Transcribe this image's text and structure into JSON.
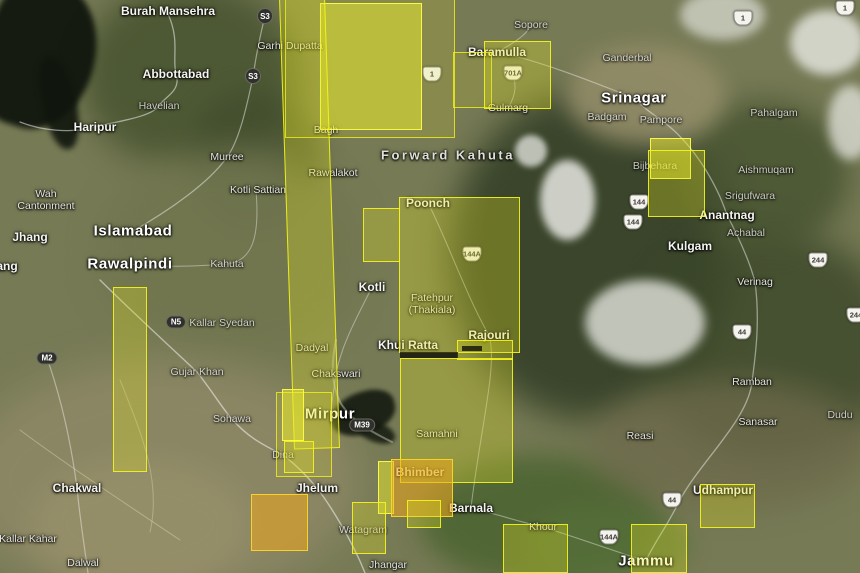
{
  "app": {
    "name": "satellite-map-viewer",
    "region": "Kashmir / Northern Pakistan"
  },
  "colors": {
    "footprint_yellow": "#e2e222",
    "footprint_bright": "#ededd2d",
    "footprint_orange": "#eea81c",
    "footprint_border": "#f5f519",
    "shield_dark": "#30312c",
    "shield_light": "#f5f3ee",
    "terrain_base": "#767a55"
  },
  "map": {
    "labels": [
      {
        "text": "Burah Mansehra",
        "x": 168,
        "y": 11,
        "s": "md"
      },
      {
        "text": "Abbottabad",
        "x": 176,
        "y": 74,
        "s": "md"
      },
      {
        "text": "Havelian",
        "x": 159,
        "y": 106,
        "s": "sm",
        "dim": true
      },
      {
        "text": "Haripur",
        "x": 95,
        "y": 127,
        "s": "md"
      },
      {
        "text": "Murree",
        "x": 227,
        "y": 157,
        "s": "sm"
      },
      {
        "text": "Kotli Sattian",
        "x": 258,
        "y": 190,
        "s": "sm"
      },
      {
        "text": "Wah Cantonment",
        "x": 46,
        "y": 200,
        "s": "sm",
        "w": 64
      },
      {
        "text": "Jhang",
        "x": 30,
        "y": 237,
        "s": "md"
      },
      {
        "text": "Islamabad",
        "x": 133,
        "y": 231,
        "s": "lg"
      },
      {
        "text": "Rawalpindi",
        "x": 130,
        "y": 264,
        "s": "lg"
      },
      {
        "text": "Kahuta",
        "x": 227,
        "y": 264,
        "s": "sm",
        "dim": true
      },
      {
        "text": "Fateh Jang",
        "x": -14,
        "y": 266,
        "s": "md"
      },
      {
        "text": "Kallar Syedan",
        "x": 222,
        "y": 323,
        "s": "sm",
        "dim": true
      },
      {
        "text": "Gujar Khan",
        "x": 197,
        "y": 372,
        "s": "sm",
        "dim": true
      },
      {
        "text": "Sohawa",
        "x": 232,
        "y": 419,
        "s": "sm",
        "dim": true
      },
      {
        "text": "Chakwal",
        "x": 77,
        "y": 488,
        "s": "md"
      },
      {
        "text": "Kallar Kahar",
        "x": 28,
        "y": 539,
        "s": "sm"
      },
      {
        "text": "Dalwal",
        "x": 83,
        "y": 563,
        "s": "sm"
      },
      {
        "text": "Dina",
        "x": 283,
        "y": 455,
        "s": "sm",
        "dim": true
      },
      {
        "text": "Jhelum",
        "x": 317,
        "y": 488,
        "s": "md"
      },
      {
        "text": "Mirpur",
        "x": 330,
        "y": 414,
        "s": "lg"
      },
      {
        "text": "Chakswari",
        "x": 336,
        "y": 374,
        "s": "sm"
      },
      {
        "text": "Dadyal",
        "x": 312,
        "y": 348,
        "s": "sm"
      },
      {
        "text": "Jhangar",
        "x": 388,
        "y": 565,
        "s": "sm"
      },
      {
        "text": "Watagram",
        "x": 363,
        "y": 530,
        "s": "sm",
        "dim": true
      },
      {
        "text": "Bhimber",
        "x": 420,
        "y": 472,
        "s": "md"
      },
      {
        "text": "Barnala",
        "x": 471,
        "y": 508,
        "s": "md"
      },
      {
        "text": "Samahni",
        "x": 437,
        "y": 434,
        "s": "sm"
      },
      {
        "text": "Khui Ratta",
        "x": 408,
        "y": 345,
        "s": "md"
      },
      {
        "text": "Kotli",
        "x": 372,
        "y": 287,
        "s": "md"
      },
      {
        "text": "Fatehpur (Thakiala)",
        "x": 432,
        "y": 304,
        "s": "sm",
        "w": 62
      },
      {
        "text": "Rajouri",
        "x": 489,
        "y": 335,
        "s": "md"
      },
      {
        "text": "Poonch",
        "x": 428,
        "y": 203,
        "s": "md"
      },
      {
        "text": "Forward Kahuta",
        "x": 448,
        "y": 155,
        "s": "area"
      },
      {
        "text": "Bagh",
        "x": 326,
        "y": 130,
        "s": "sm"
      },
      {
        "text": "Rawalakot",
        "x": 333,
        "y": 173,
        "s": "sm"
      },
      {
        "text": "Garhi Dupatta",
        "x": 290,
        "y": 46,
        "s": "sm"
      },
      {
        "text": "Sopore",
        "x": 531,
        "y": 25,
        "s": "sm",
        "dim": true
      },
      {
        "text": "Baramulla",
        "x": 497,
        "y": 52,
        "s": "md"
      },
      {
        "text": "Gulmarg",
        "x": 508,
        "y": 108,
        "s": "sm"
      },
      {
        "text": "Srinagar",
        "x": 634,
        "y": 98,
        "s": "lg"
      },
      {
        "text": "Ganderbal",
        "x": 627,
        "y": 58,
        "s": "sm",
        "dim": true
      },
      {
        "text": "Badgam",
        "x": 607,
        "y": 117,
        "s": "sm",
        "dim": true
      },
      {
        "text": "Pampore",
        "x": 661,
        "y": 120,
        "s": "sm",
        "dim": true
      },
      {
        "text": "Pahalgam",
        "x": 774,
        "y": 113,
        "s": "sm",
        "dim": true
      },
      {
        "text": "Aishmuqam",
        "x": 766,
        "y": 170,
        "s": "sm",
        "dim": true
      },
      {
        "text": "Srigufwara",
        "x": 750,
        "y": 196,
        "s": "sm",
        "dim": true
      },
      {
        "text": "Bijbehara",
        "x": 655,
        "y": 166,
        "s": "sm",
        "dim": true
      },
      {
        "text": "Anantnag",
        "x": 727,
        "y": 215,
        "s": "md"
      },
      {
        "text": "Achabal",
        "x": 746,
        "y": 233,
        "s": "sm",
        "dim": true
      },
      {
        "text": "Kulgam",
        "x": 690,
        "y": 246,
        "s": "md"
      },
      {
        "text": "Verinag",
        "x": 755,
        "y": 282,
        "s": "sm"
      },
      {
        "text": "Ramban",
        "x": 752,
        "y": 382,
        "s": "sm"
      },
      {
        "text": "Sanasar",
        "x": 758,
        "y": 422,
        "s": "sm"
      },
      {
        "text": "Dudu",
        "x": 840,
        "y": 415,
        "s": "sm",
        "dim": true
      },
      {
        "text": "Reasi",
        "x": 640,
        "y": 436,
        "s": "sm"
      },
      {
        "text": "Udhampur",
        "x": 723,
        "y": 490,
        "s": "md"
      },
      {
        "text": "Jammu",
        "x": 646,
        "y": 561,
        "s": "lg"
      },
      {
        "text": "Khour",
        "x": 543,
        "y": 527,
        "s": "sm"
      }
    ],
    "shields": [
      {
        "type": "circle",
        "text": "S3",
        "x": 265,
        "y": 16
      },
      {
        "type": "circle",
        "text": "S3",
        "x": 253,
        "y": 76
      },
      {
        "type": "pill",
        "text": "N5",
        "x": 176,
        "y": 322
      },
      {
        "type": "pill",
        "text": "M2",
        "x": 47,
        "y": 358
      },
      {
        "type": "pill",
        "text": "M39",
        "x": 362,
        "y": 425
      },
      {
        "type": "nh",
        "text": "1",
        "x": 743,
        "y": 18
      },
      {
        "type": "nh",
        "text": "1",
        "x": 845,
        "y": 8
      },
      {
        "type": "nh",
        "text": "1",
        "x": 432,
        "y": 74
      },
      {
        "type": "nh",
        "text": "701A",
        "x": 513,
        "y": 73
      },
      {
        "type": "nh",
        "text": "144A",
        "x": 472,
        "y": 254
      },
      {
        "type": "nh",
        "text": "144",
        "x": 639,
        "y": 202
      },
      {
        "type": "nh",
        "text": "144",
        "x": 633,
        "y": 222
      },
      {
        "type": "nh",
        "text": "244",
        "x": 818,
        "y": 260
      },
      {
        "type": "nh",
        "text": "244",
        "x": 856,
        "y": 315
      },
      {
        "type": "nh",
        "text": "44",
        "x": 742,
        "y": 332
      },
      {
        "type": "nh",
        "text": "44",
        "x": 672,
        "y": 500
      },
      {
        "type": "nh",
        "text": "144A",
        "x": 609,
        "y": 537
      }
    ],
    "footprints": [
      {
        "id": "top-wide-outline",
        "x": 285,
        "y": -2,
        "w": 170,
        "h": 140,
        "tone": "faint"
      },
      {
        "id": "top-arm-baramulla",
        "x": 453,
        "y": 52,
        "w": 39,
        "h": 56,
        "tone": "faint"
      },
      {
        "id": "top-bright-block",
        "x": 320,
        "y": 3,
        "w": 102,
        "h": 127,
        "tone": "bright"
      },
      {
        "id": "central-long-strip",
        "x": 279,
        "y": -3,
        "w": 46,
        "h": 452,
        "tone": "mid",
        "rot": -1.9
      },
      {
        "id": "baramulla-gulmarg",
        "x": 484,
        "y": 41,
        "w": 67,
        "h": 68,
        "tone": "mid"
      },
      {
        "id": "pampore-small",
        "x": 650,
        "y": 138,
        "w": 41,
        "h": 41,
        "tone": "bright"
      },
      {
        "id": "pampore-large",
        "x": 648,
        "y": 150,
        "w": 57,
        "h": 67,
        "tone": "mid"
      },
      {
        "id": "kotli-small",
        "x": 363,
        "y": 208,
        "w": 37,
        "h": 54,
        "tone": "mid"
      },
      {
        "id": "poonch-rajouri",
        "x": 399,
        "y": 197,
        "w": 121,
        "h": 156,
        "tone": "mid"
      },
      {
        "id": "samahni-main",
        "x": 400,
        "y": 358,
        "w": 113,
        "h": 125,
        "tone": "mid"
      },
      {
        "id": "samahni-step",
        "x": 457,
        "y": 340,
        "w": 56,
        "h": 20,
        "tone": "mid"
      },
      {
        "id": "bhimber-left-strip",
        "x": 378,
        "y": 461,
        "w": 16,
        "h": 53,
        "tone": "bright"
      },
      {
        "id": "bhimber-orange",
        "x": 391,
        "y": 459,
        "w": 62,
        "h": 58,
        "tone": "orange"
      },
      {
        "id": "barnala-tab",
        "x": 407,
        "y": 500,
        "w": 34,
        "h": 28,
        "tone": "mid"
      },
      {
        "id": "chakwal-strip",
        "x": 113,
        "y": 287,
        "w": 34,
        "h": 185,
        "tone": "mid"
      },
      {
        "id": "mirpur-outline",
        "x": 276,
        "y": 392,
        "w": 56,
        "h": 85,
        "tone": "faint"
      },
      {
        "id": "mirpur-bright",
        "x": 282,
        "y": 389,
        "w": 22,
        "h": 52,
        "tone": "bright"
      },
      {
        "id": "mirpur-lower",
        "x": 284,
        "y": 441,
        "w": 30,
        "h": 32,
        "tone": "mid"
      },
      {
        "id": "jhelum-orange",
        "x": 251,
        "y": 494,
        "w": 57,
        "h": 57,
        "tone": "orange"
      },
      {
        "id": "watagram-rect",
        "x": 352,
        "y": 502,
        "w": 34,
        "h": 52,
        "tone": "mid"
      },
      {
        "id": "khour-rect",
        "x": 503,
        "y": 524,
        "w": 65,
        "h": 49,
        "tone": "mid"
      },
      {
        "id": "udhampur-rect",
        "x": 700,
        "y": 484,
        "w": 55,
        "h": 44,
        "tone": "mid"
      },
      {
        "id": "jammu-rect",
        "x": 631,
        "y": 524,
        "w": 56,
        "h": 49,
        "tone": "mid"
      }
    ],
    "gap_bars": [
      {
        "x": 400,
        "y": 352,
        "w": 58,
        "h": 6
      },
      {
        "x": 462,
        "y": 346,
        "w": 20,
        "h": 5
      }
    ]
  }
}
